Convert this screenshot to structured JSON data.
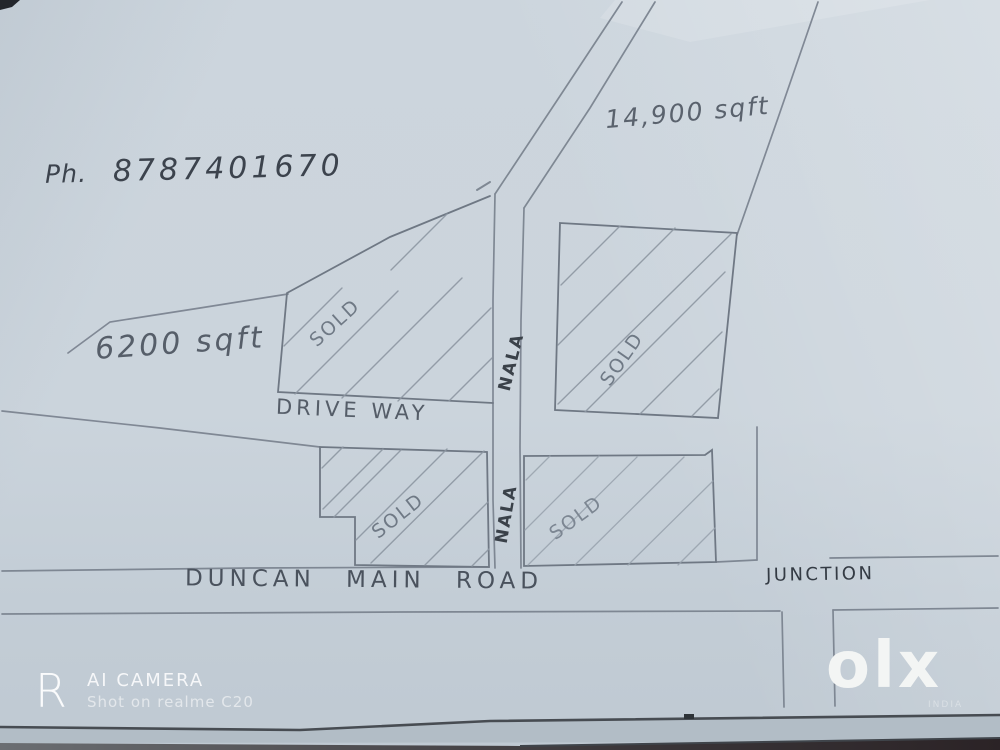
{
  "sketch": {
    "phone": {
      "label": "Ph.",
      "number": "8787401670"
    },
    "areas": {
      "top_right": "14,900 sqft",
      "left": "6200 sqft"
    },
    "driveway_label": "DRIVE WAY",
    "main_road_label": "DUNCAN MAIN ROAD",
    "junction_label": "JUNCTION",
    "nala": {
      "upper": "NALA",
      "lower": "NALA"
    },
    "plots": [
      {
        "name": "upper-left",
        "status": "SOLD"
      },
      {
        "name": "upper-right",
        "status": "SOLD"
      },
      {
        "name": "lower-left",
        "status": "SOLD"
      },
      {
        "name": "lower-right",
        "status": "SOLD"
      }
    ]
  },
  "watermark": {
    "logo_letter": "R",
    "title": "AI CAMERA",
    "subtitle": "Shot on realme C20"
  },
  "platform_logo": {
    "text": "olx",
    "region": "INDIA"
  },
  "colors": {
    "paper": "#ccd5dd",
    "pencil": "#7b8490",
    "hatch": "#8d97a2",
    "ink": "#3a4149",
    "watermark": "#ffffff",
    "table_dark": "#2b2326"
  }
}
